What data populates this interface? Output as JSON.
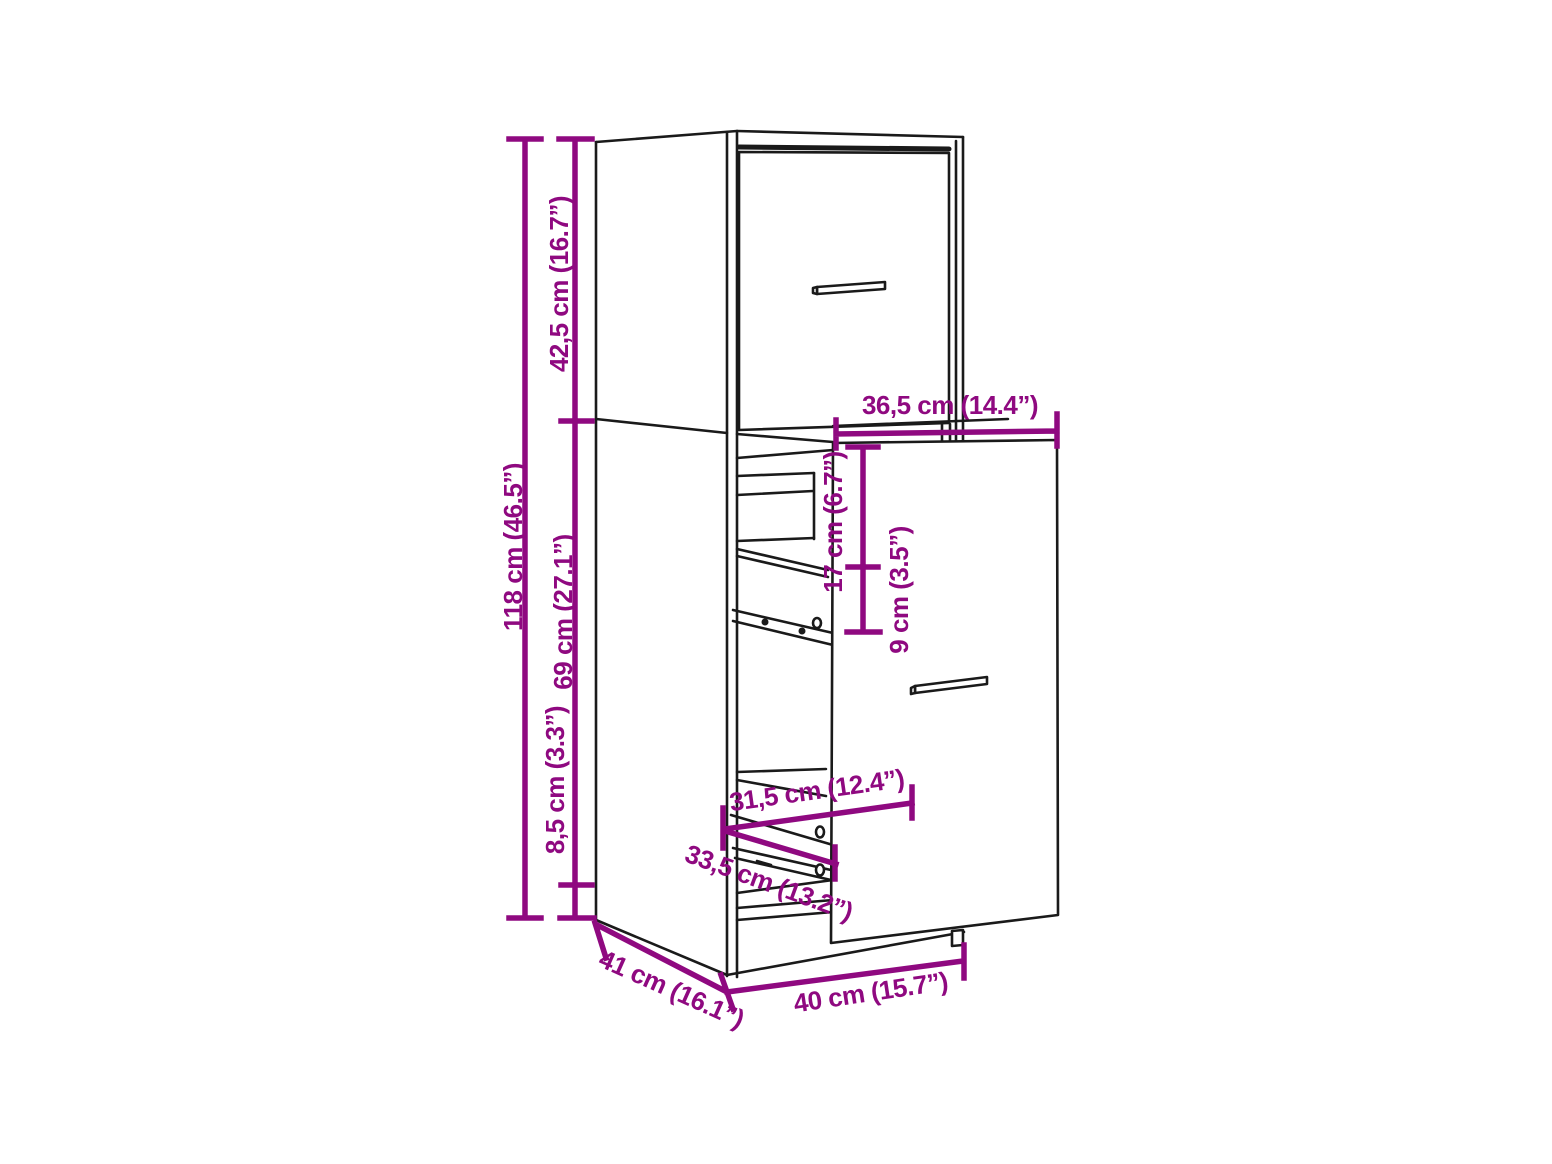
{
  "diagram": {
    "dimensions": {
      "upper_section_height": "42,5 cm (16.7”)",
      "total_height": "118 cm (46.5”)",
      "lower_section_height": "69 cm (27.1”)",
      "base_height": "8,5 cm (3.3”)",
      "pullout_front_width": "36,5 cm (14.4”)",
      "upper_gap_height": "17 cm (6.7”)",
      "shelf_gap_height": "9 cm (3.5”)",
      "inner_shelf_width": "31,5 cm (12.4”)",
      "rail_length": "33,5 cm (13.2”)",
      "depth": "41 cm (16.1”)",
      "width": "40 cm (15.7”)"
    },
    "colors": {
      "dimension_accent": "#8F0980",
      "outline": "#1A1A1A",
      "background": "#FFFFFF"
    }
  }
}
